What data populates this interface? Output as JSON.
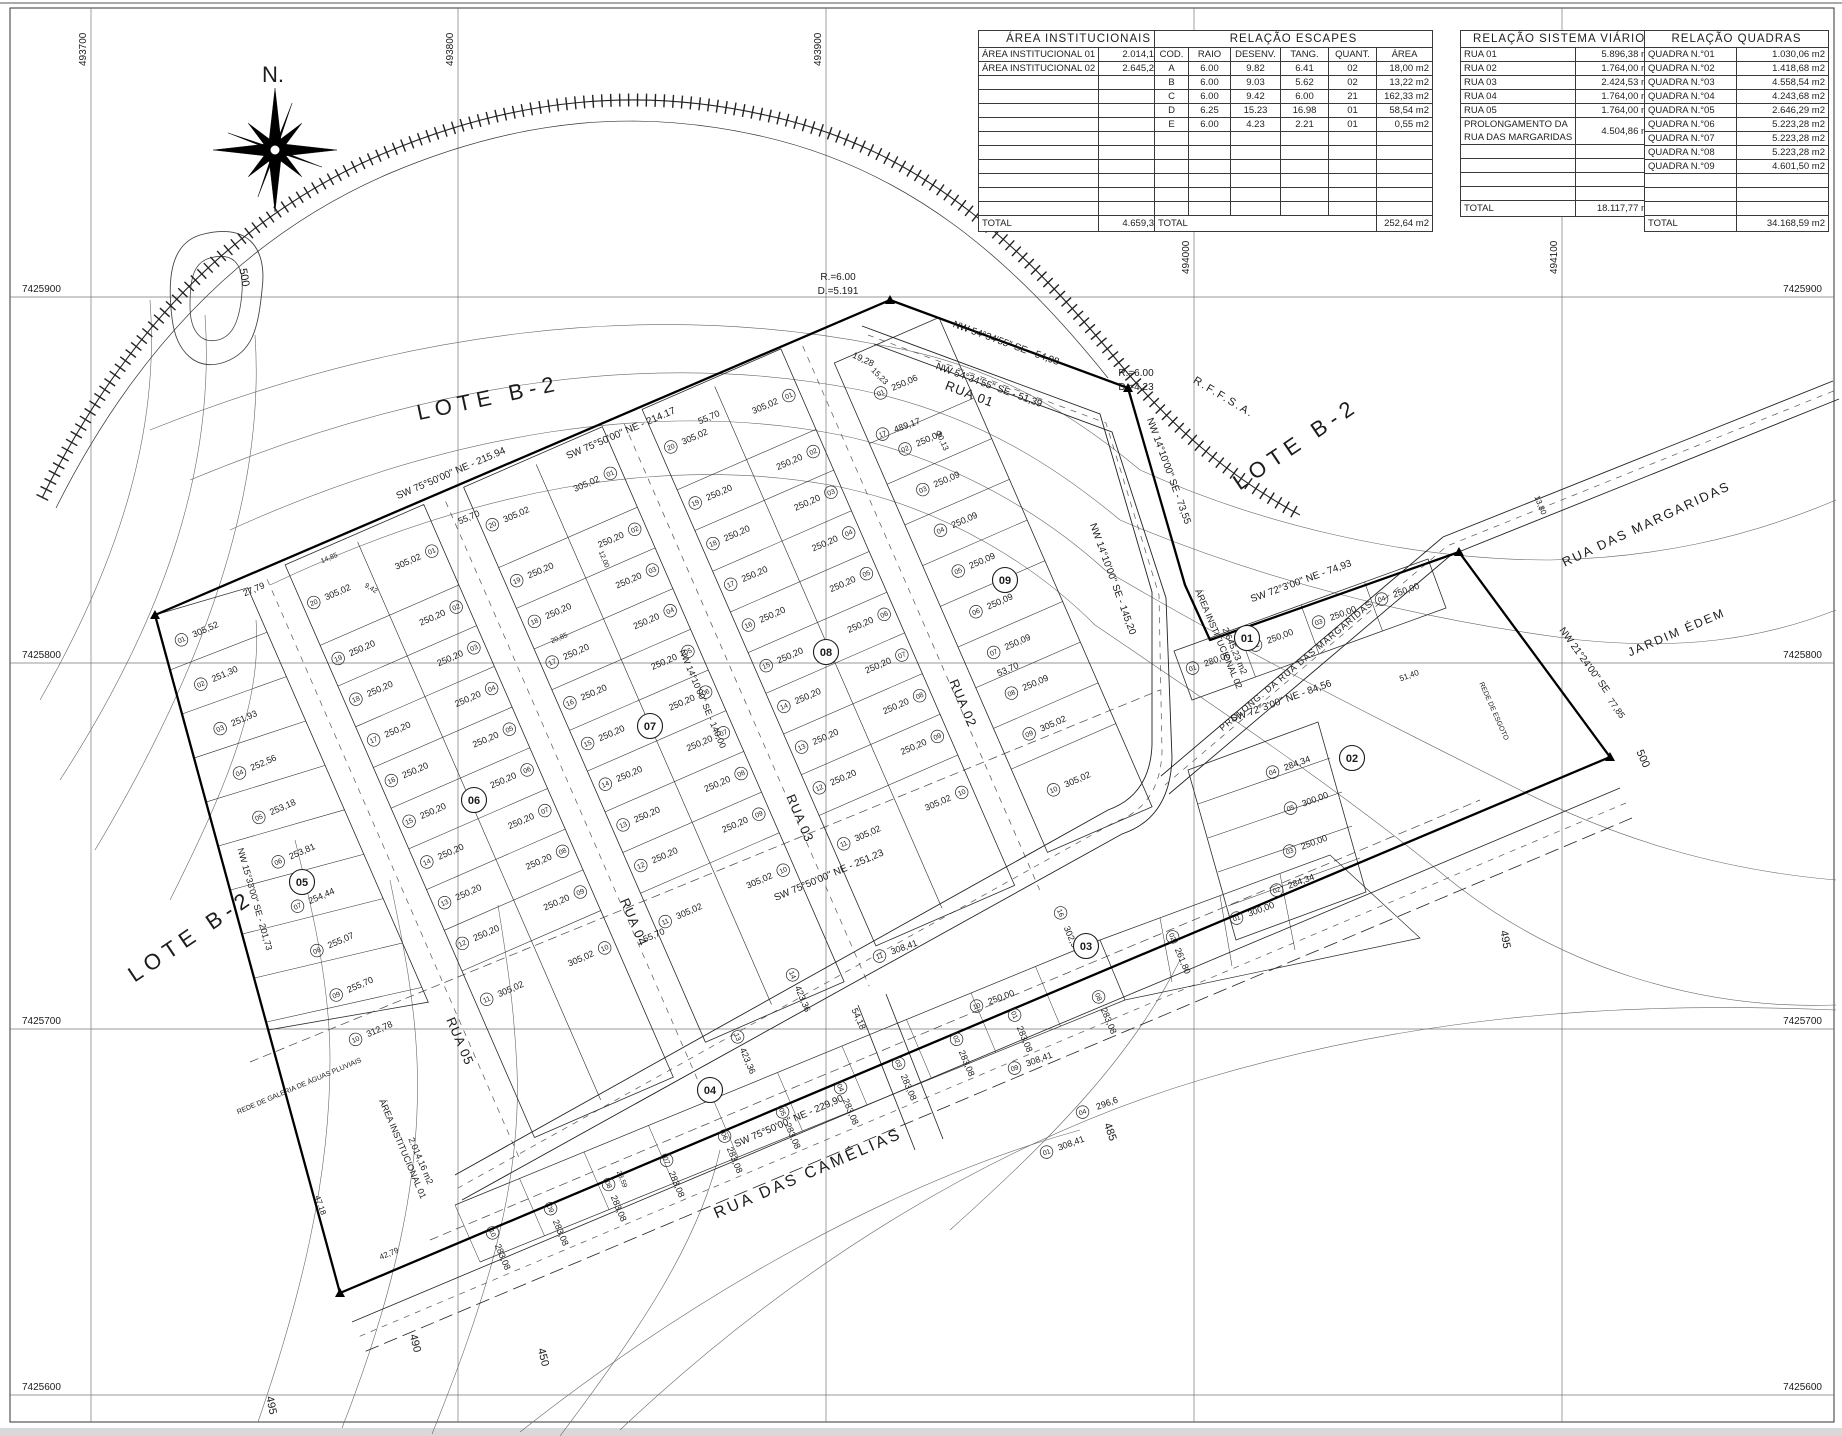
{
  "compass": {
    "label": "N."
  },
  "grid": {
    "x_labels": [
      {
        "t": "493700",
        "x": 91,
        "ly": 66
      },
      {
        "t": "493800",
        "x": 458,
        "ly": 66
      },
      {
        "t": "493900",
        "x": 826,
        "ly": 66
      },
      {
        "t": "494000",
        "x": 1194,
        "ly": 274
      },
      {
        "t": "494100",
        "x": 1562,
        "ly": 274
      }
    ],
    "y_labels": [
      {
        "t": "7425900",
        "y": 297
      },
      {
        "t": "7425800",
        "y": 663
      },
      {
        "t": "7425700",
        "y": 1029
      },
      {
        "t": "7425600",
        "y": 1395
      }
    ]
  },
  "tables": {
    "institucionais": {
      "title": "ÁREA INSTITUCIONAIS",
      "rows": [
        [
          "ÁREA INSTITUCIONAL 01",
          "2.014,16 m2"
        ],
        [
          "ÁREA INSTITUCIONAL 02",
          "2.645,23 m2"
        ]
      ],
      "empty_rows": 10,
      "total_label": "TOTAL",
      "total": "4.659,39 m2"
    },
    "escapes": {
      "title": "RELAÇÃO ESCAPES",
      "headers": [
        "COD.",
        "RAIO",
        "DESENV.",
        "TANG.",
        "QUANT.",
        "ÁREA"
      ],
      "rows": [
        [
          "A",
          "6.00",
          "9.82",
          "6.41",
          "02",
          "18,00 m2"
        ],
        [
          "B",
          "6.00",
          "9.03",
          "5.62",
          "02",
          "13,22 m2"
        ],
        [
          "C",
          "6.00",
          "9.42",
          "6.00",
          "21",
          "162,33 m2"
        ],
        [
          "D",
          "6.25",
          "15.23",
          "16.98",
          "01",
          "58,54 m2"
        ],
        [
          "E",
          "6.00",
          "4.23",
          "2.21",
          "01",
          "0,55 m2"
        ]
      ],
      "empty_rows": 6,
      "total_label": "TOTAL",
      "total": "252,64 m2"
    },
    "viario": {
      "title": "RELAÇÃO SISTEMA VIÁRIO",
      "rows": [
        [
          "RUA 01",
          "5.896,38 m2"
        ],
        [
          "RUA 02",
          "1.764,00 m2"
        ],
        [
          "RUA 03",
          "2.424,53 m2"
        ],
        [
          "RUA 04",
          "1.764,00 m2"
        ],
        [
          "RUA 05",
          "1.764,00 m2"
        ]
      ],
      "merged_row": {
        "line1": "PROLONGAMENTO DA",
        "line2": "RUA DAS MARGARIDAS",
        "value": "4.504,86 m2"
      },
      "empty_rows": 5,
      "total_label": "TOTAL",
      "total": "18.117,77 m2"
    },
    "quadras": {
      "title": "RELAÇÃO QUADRAS",
      "rows": [
        [
          "QUADRA N.°01",
          "1.030,06 m2"
        ],
        [
          "QUADRA N.°02",
          "1.418,68 m2"
        ],
        [
          "QUADRA N.°03",
          "4.558,54 m2"
        ],
        [
          "QUADRA N.°04",
          "4.243,68 m2"
        ],
        [
          "QUADRA N.°05",
          "2.646,29 m2"
        ],
        [
          "QUADRA N.°06",
          "5.223,28 m2"
        ],
        [
          "QUADRA N.°07",
          "5.223,28 m2"
        ],
        [
          "QUADRA N.°08",
          "5.223,28 m2"
        ],
        [
          "QUADRA N.°09",
          "4.601,50 m2"
        ]
      ],
      "empty_rows": 3,
      "total_label": "TOTAL",
      "total": "34.168,59 m2"
    }
  },
  "lot_areas": {
    "q5": [
      "305,52",
      "251,30",
      "251,93",
      "252,56",
      "253,18",
      "253,81",
      "254,44",
      "255,07",
      "255,70",
      "312,78"
    ],
    "std": [
      "305,02",
      "250,20",
      "250,20",
      "250,20",
      "250,20",
      "250,20",
      "250,20",
      "250,20",
      "250,20",
      "305,02"
    ],
    "q9": [
      "250,06",
      "250,09",
      "250,09",
      "250,09",
      "250,09",
      "250,09",
      "250,09",
      "250,09",
      "305,02",
      "305,02"
    ]
  },
  "quadra_circles": [
    {
      "n": "05",
      "x": 302,
      "y": 882
    },
    {
      "n": "06",
      "x": 474,
      "y": 800
    },
    {
      "n": "07",
      "x": 650,
      "y": 726
    },
    {
      "n": "08",
      "x": 826,
      "y": 652
    },
    {
      "n": "09",
      "x": 1005,
      "y": 580
    },
    {
      "n": "01",
      "x": 1247,
      "y": 638
    },
    {
      "n": "02",
      "x": 1352,
      "y": 758
    },
    {
      "n": "03",
      "x": 1086,
      "y": 946
    },
    {
      "n": "04",
      "x": 710,
      "y": 1090
    }
  ],
  "explicit_lots": [
    {
      "n": "01",
      "a": "280,06",
      "x": 1218,
      "y": 662,
      "r": -20
    },
    {
      "n": "02",
      "a": "250,00",
      "x": 1281,
      "y": 639,
      "r": -20
    },
    {
      "n": "03",
      "a": "250,00",
      "x": 1344,
      "y": 616,
      "r": -20
    },
    {
      "n": "04",
      "a": "250,00",
      "x": 1407,
      "y": 593,
      "r": -20
    },
    {
      "n": "01",
      "a": "300,00",
      "x": 1262,
      "y": 912,
      "r": -20
    },
    {
      "n": "02",
      "a": "284,34",
      "x": 1302,
      "y": 884,
      "r": -20
    },
    {
      "n": "03",
      "a": "250,00",
      "x": 1315,
      "y": 845,
      "r": -20
    },
    {
      "n": "05",
      "a": "300,00",
      "x": 1316,
      "y": 802,
      "r": -20
    },
    {
      "n": "04",
      "a": "284,34",
      "x": 1298,
      "y": 766,
      "r": -20
    },
    {
      "n": "11",
      "a": "308,41",
      "x": 905,
      "y": 950,
      "r": -20
    },
    {
      "n": "10",
      "a": "250,00",
      "x": 1002,
      "y": 1000,
      "r": -20
    },
    {
      "n": "09",
      "a": "308,41",
      "x": 1040,
      "y": 1062,
      "r": -20
    },
    {
      "n": "16",
      "a": "302,5",
      "x": 1068,
      "y": 938,
      "r": 67
    },
    {
      "n": "02",
      "a": "261,80",
      "x": 1180,
      "y": 962,
      "r": 67
    },
    {
      "n": "04",
      "a": "296,6",
      "x": 1108,
      "y": 1106,
      "r": -20
    },
    {
      "n": "08",
      "a": "283,08",
      "x": 1106,
      "y": 1022,
      "r": 67
    },
    {
      "n": "01",
      "a": "308,41",
      "x": 1072,
      "y": 1146,
      "r": -20
    },
    {
      "n": "14",
      "a": "423,36",
      "x": 800,
      "y": 1000,
      "r": 67
    },
    {
      "n": "13",
      "a": "423,36",
      "x": 745,
      "y": 1062,
      "r": 67
    },
    {
      "n": "17",
      "a": "489,17",
      "x": 908,
      "y": 428,
      "r": -20
    }
  ],
  "q4_band": {
    "area": "283,08",
    "nums": [
      "10",
      "09",
      "08",
      "07",
      "06",
      "05",
      "04",
      "03",
      "02",
      "01"
    ]
  },
  "street_names": [
    {
      "t": "RUA 01",
      "x": 968,
      "y": 398,
      "r": 21,
      "s": 13
    },
    {
      "t": "RUA 02",
      "x": 959,
      "y": 705,
      "r": 67,
      "s": 13
    },
    {
      "t": "RUA 03",
      "x": 796,
      "y": 820,
      "r": 67,
      "s": 13
    },
    {
      "t": "RUA 04",
      "x": 630,
      "y": 924,
      "r": 67,
      "s": 13
    },
    {
      "t": "RUA 05",
      "x": 456,
      "y": 1043,
      "r": 67,
      "s": 13
    },
    {
      "t": "RUA DAS CAMÉLIAS",
      "x": 810,
      "y": 1178,
      "r": -23.5,
      "s": 16,
      "ls": 3
    },
    {
      "t": "RUA DAS MARGARIDAS",
      "x": 1648,
      "y": 528,
      "r": -25,
      "s": 13,
      "ls": 2
    },
    {
      "t": "PROLONG. DA RUA DAS MARGARIDAS",
      "x": 1298,
      "y": 668,
      "r": -40,
      "s": 9
    },
    {
      "t": "JARDIM ÉDEM",
      "x": 1678,
      "y": 636,
      "r": -23,
      "s": 12,
      "ls": 2
    }
  ],
  "map_labels": [
    {
      "t": "LOTE B-2",
      "x": 490,
      "y": 405,
      "r": -12,
      "s": 22,
      "ls": 6
    },
    {
      "t": "LOTE B-2",
      "x": 1300,
      "y": 450,
      "r": -34,
      "s": 22,
      "ls": 6
    },
    {
      "t": "LOTE B-2",
      "x": 195,
      "y": 942,
      "r": -34,
      "s": 22,
      "ls": 6
    },
    {
      "t": "R.F.F.S.A.",
      "x": 1222,
      "y": 400,
      "r": 31,
      "s": 11,
      "ls": 2
    },
    {
      "t": "ÁREA INSTITUCIONAL 01",
      "x": 400,
      "y": 1150,
      "r": 67,
      "s": 9
    },
    {
      "t": "2.014,16 m2",
      "x": 418,
      "y": 1162,
      "r": 67,
      "s": 9
    },
    {
      "t": "ÁREA INSTITUCIONAL 02",
      "x": 1216,
      "y": 640,
      "r": 67,
      "s": 9
    },
    {
      "t": "2.645,23 m2",
      "x": 1232,
      "y": 652,
      "r": 67,
      "s": 9
    },
    {
      "t": "REDE DE GALERIA DE ÁGUAS PLUVIAIS",
      "x": 300,
      "y": 1088,
      "r": -23,
      "s": 7
    },
    {
      "t": "REDE DE ESGOTO",
      "x": 1492,
      "y": 712,
      "r": 66,
      "s": 7
    },
    {
      "t": "R.=6.00",
      "x": 838,
      "y": 280,
      "r": 0,
      "s": 10
    },
    {
      "t": "D.=5.191",
      "x": 838,
      "y": 294,
      "r": 0,
      "s": 10
    },
    {
      "t": "R.=6.00",
      "x": 1136,
      "y": 376,
      "r": 0,
      "s": 10
    },
    {
      "t": "D.=4.23",
      "x": 1136,
      "y": 390,
      "r": 0,
      "s": 10
    },
    {
      "t": "500",
      "x": 241,
      "y": 278,
      "r": 80,
      "s": 11
    },
    {
      "t": "500",
      "x": 1640,
      "y": 760,
      "r": 66,
      "s": 11
    },
    {
      "t": "495",
      "x": 1502,
      "y": 940,
      "r": 80,
      "s": 11
    },
    {
      "t": "495",
      "x": 268,
      "y": 1406,
      "r": 78,
      "s": 11
    },
    {
      "t": "490",
      "x": 412,
      "y": 1344,
      "r": 76,
      "s": 11
    },
    {
      "t": "485",
      "x": 1107,
      "y": 1133,
      "r": 70,
      "s": 11
    },
    {
      "t": "450",
      "x": 540,
      "y": 1358,
      "r": 76,
      "s": 11
    }
  ],
  "bearings": [
    {
      "t": "SW 75°50'00\" NE - 215.94",
      "x": 452,
      "y": 476,
      "r": -23.2,
      "s": 10
    },
    {
      "t": "SW 75°50'00\" NE - 214.17",
      "x": 622,
      "y": 436,
      "r": -23.2,
      "s": 10
    },
    {
      "t": "NW 54°34'55\" SE - 54,98",
      "x": 1005,
      "y": 346,
      "r": 20,
      "s": 10
    },
    {
      "t": "NW 54°34'55\" SE - 51,39",
      "x": 988,
      "y": 388,
      "r": 20,
      "s": 10
    },
    {
      "t": "NW 14°10'00\" SE - 73,55",
      "x": 1166,
      "y": 472,
      "r": 70,
      "s": 10
    },
    {
      "t": "NW 14°10'00\" SE - 145,20",
      "x": 1110,
      "y": 580,
      "r": 70,
      "s": 10
    },
    {
      "t": "SW 72°3'00\" NE - 74,93",
      "x": 1302,
      "y": 584,
      "r": -20,
      "s": 10
    },
    {
      "t": "SW 72°3'00\" NE - 84,56",
      "x": 1282,
      "y": 704,
      "r": -20,
      "s": 10
    },
    {
      "t": "NW 21°24'00\" SE",
      "x": 1582,
      "y": 662,
      "r": 54,
      "s": 10
    },
    {
      "t": "SW 75°50'00\" NE - 229,90",
      "x": 790,
      "y": 1124,
      "r": -23.5,
      "s": 10
    },
    {
      "t": "SW 75°50'00\" NE - 251,23",
      "x": 830,
      "y": 878,
      "r": -23,
      "s": 10
    },
    {
      "t": "NW 14°10'00\" SE - 140,00",
      "x": 700,
      "y": 700,
      "r": 67,
      "s": 9
    },
    {
      "t": "NW 15°33'00\" SE - 201,73",
      "x": 252,
      "y": 900,
      "r": 74,
      "s": 9
    }
  ],
  "dims": [
    {
      "t": "27,79",
      "x": 255,
      "y": 592,
      "r": -23,
      "s": 9
    },
    {
      "t": "55,70",
      "x": 470,
      "y": 520,
      "r": -23,
      "s": 9
    },
    {
      "t": "55,70",
      "x": 710,
      "y": 420,
      "r": -23,
      "s": 9
    },
    {
      "t": "55,70",
      "x": 655,
      "y": 938,
      "r": -23,
      "s": 9
    },
    {
      "t": "53,70",
      "x": 1009,
      "y": 672,
      "r": -23,
      "s": 9
    },
    {
      "t": "19,28",
      "x": 862,
      "y": 362,
      "r": 25,
      "s": 9
    },
    {
      "t": "30,13",
      "x": 940,
      "y": 442,
      "r": 66,
      "s": 8
    },
    {
      "t": "15,23",
      "x": 878,
      "y": 378,
      "r": 45,
      "s": 8
    },
    {
      "t": "42,79",
      "x": 390,
      "y": 1256,
      "r": -23,
      "s": 8
    },
    {
      "t": "47,18",
      "x": 318,
      "y": 1206,
      "r": 70,
      "s": 8
    },
    {
      "t": "54,18",
      "x": 856,
      "y": 1020,
      "r": 66,
      "s": 9
    },
    {
      "t": "13,80",
      "x": 1538,
      "y": 506,
      "r": 68,
      "s": 8
    },
    {
      "t": "51,40",
      "x": 1410,
      "y": 678,
      "r": -20,
      "s": 8
    },
    {
      "t": "77,85",
      "x": 1614,
      "y": 710,
      "r": 54,
      "s": 9
    },
    {
      "t": "12,00",
      "x": 602,
      "y": 560,
      "r": 67,
      "s": 7
    },
    {
      "t": "20,85",
      "x": 560,
      "y": 640,
      "r": -23,
      "s": 7
    },
    {
      "t": "23,59",
      "x": 620,
      "y": 1180,
      "r": 67,
      "s": 7
    },
    {
      "t": "14,85",
      "x": 330,
      "y": 560,
      "r": -23,
      "s": 7
    },
    {
      "t": "9,42",
      "x": 370,
      "y": 590,
      "r": 30,
      "s": 7
    }
  ]
}
